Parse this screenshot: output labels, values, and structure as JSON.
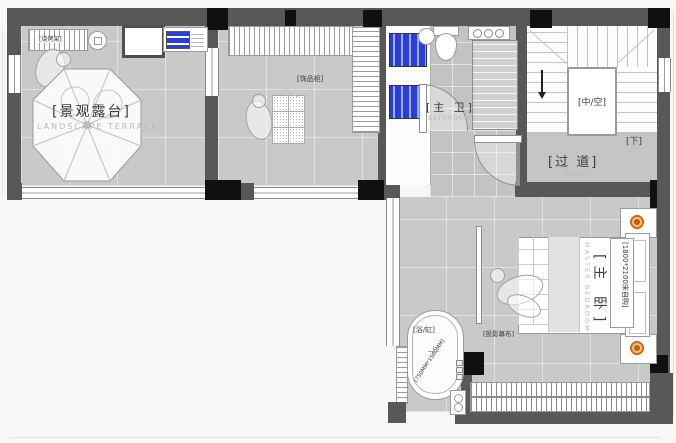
{
  "colors": {
    "floor_gray": "#c9c9c9",
    "wall_gray": "#585858",
    "column_black": "#101010",
    "appliance_blue": "#2b3fd6",
    "lamp_orange": "#d2691e",
    "label_dark": "#3d3d3d",
    "label_faint": "#b9b9b9"
  },
  "rooms": {
    "terrace": {
      "label": "[景观露台]",
      "label_en": "LANDSCAPE TERRACE",
      "bbq_label": "[烧烤架]"
    },
    "cloakroom": {
      "cabinet_label": "[饰品柜]"
    },
    "bathroom": {
      "label": "[主 卫]",
      "label_en": "BATHROOM"
    },
    "stairwell": {
      "void_label": "[中/空]",
      "down_label": "[下]"
    },
    "corridor": {
      "label": "[过 道]",
      "label_en": "AISLE"
    },
    "bedroom": {
      "label": "[主 卧]",
      "label_en": "MASTER BEDROOM",
      "bed_note": "[1800*2100床自购]",
      "screen_label": "[投影幕布]"
    },
    "bathtub": {
      "label": "[浴/缸]",
      "dim_note": "[750MM*1500MM]"
    }
  }
}
